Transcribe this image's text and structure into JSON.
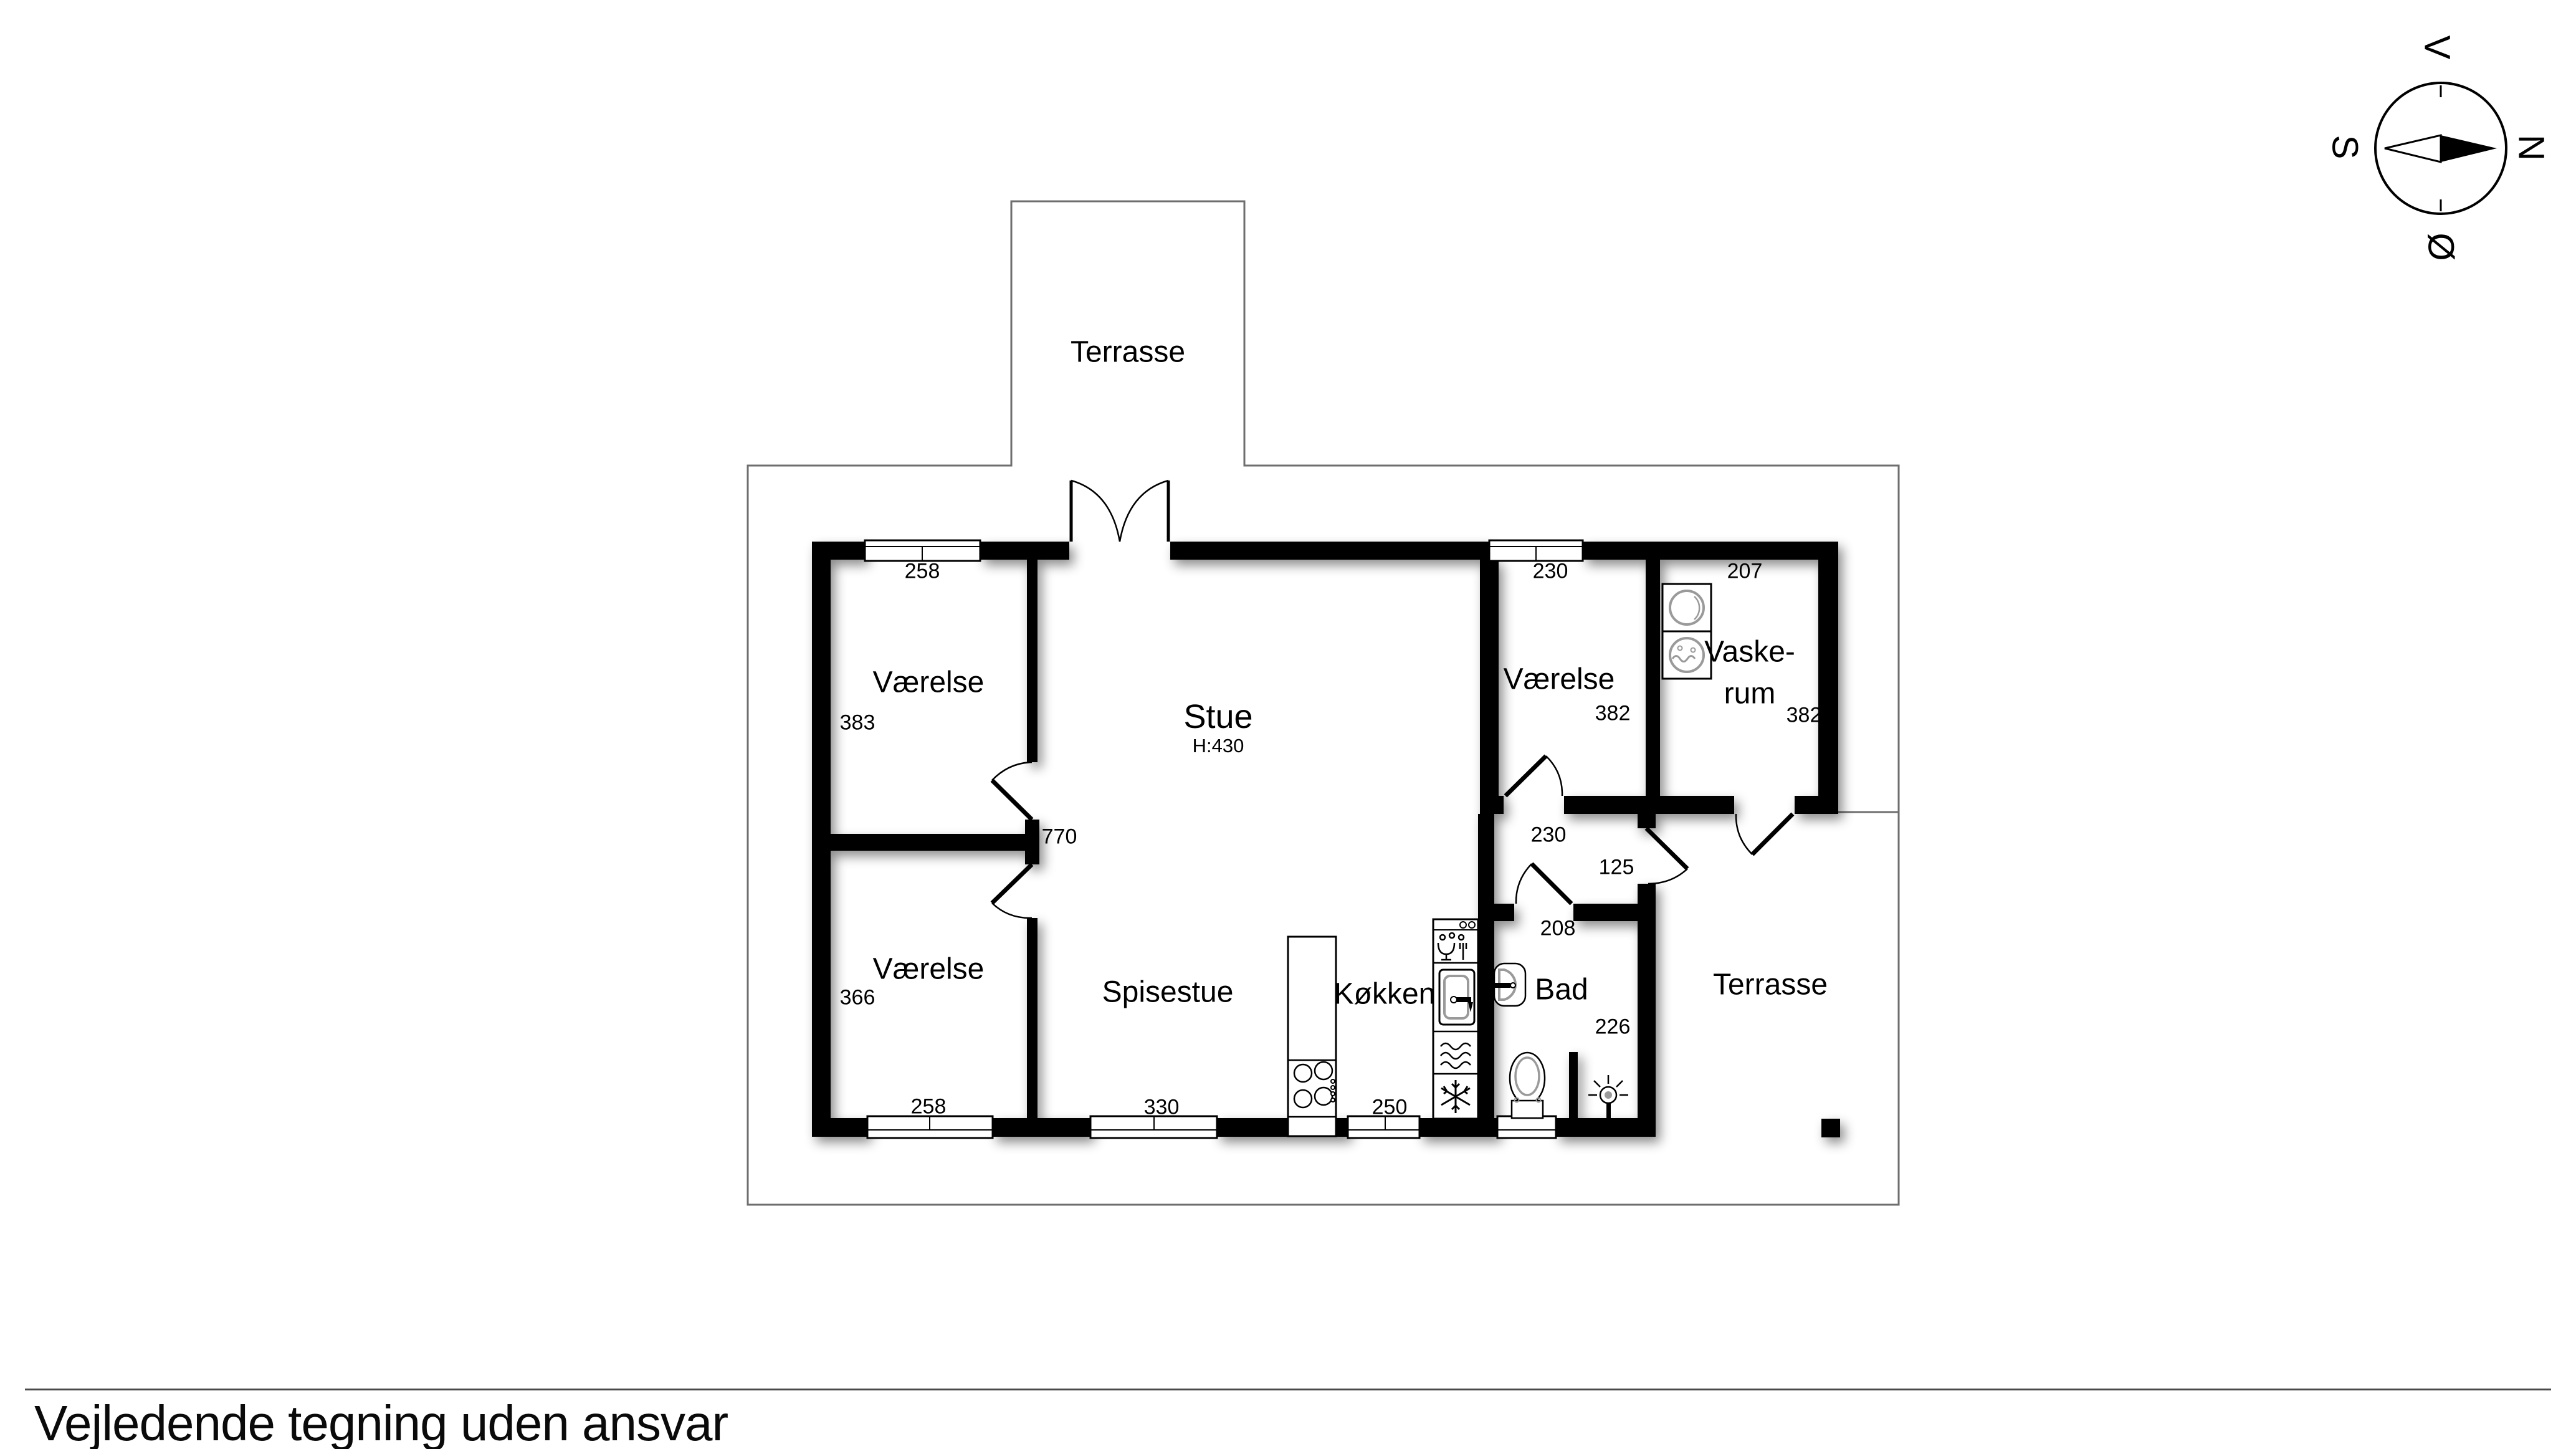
{
  "footer": {
    "disclaimer": "Vejledende tegning uden ansvar"
  },
  "compass": {
    "west": "V",
    "north": "N",
    "south": "S",
    "east": "Ø"
  },
  "rooms": {
    "terrace_top": {
      "label": "Terrasse"
    },
    "bedroom_nw": {
      "label": "Værelse",
      "window_width": "258",
      "side_depth": "383"
    },
    "living": {
      "label": "Stue",
      "ceiling_height": "H:430",
      "room_width": "770"
    },
    "bedroom_ne": {
      "label": "Værelse",
      "window_width": "230",
      "side_depth": "382",
      "door_width": "230"
    },
    "laundry": {
      "label_line1": "Vaske-",
      "label_line2": "rum",
      "top_width": "207",
      "side_depth": "382"
    },
    "bedroom_sw": {
      "label": "Værelse",
      "side_depth": "366",
      "window_width": "258"
    },
    "dining": {
      "label": "Spisestue",
      "window_width": "330"
    },
    "kitchen": {
      "label": "Køkken",
      "window_width": "250"
    },
    "bath": {
      "label": "Bad",
      "top_width": "208",
      "side_depth": "226"
    },
    "hall": {
      "terrace_door_width": "125"
    },
    "terrace_east": {
      "label": "Terrasse"
    }
  },
  "colors": {
    "wall": "#000000",
    "boundary": "#6e6e6e",
    "fixture_gray": "#9a9a9a"
  }
}
